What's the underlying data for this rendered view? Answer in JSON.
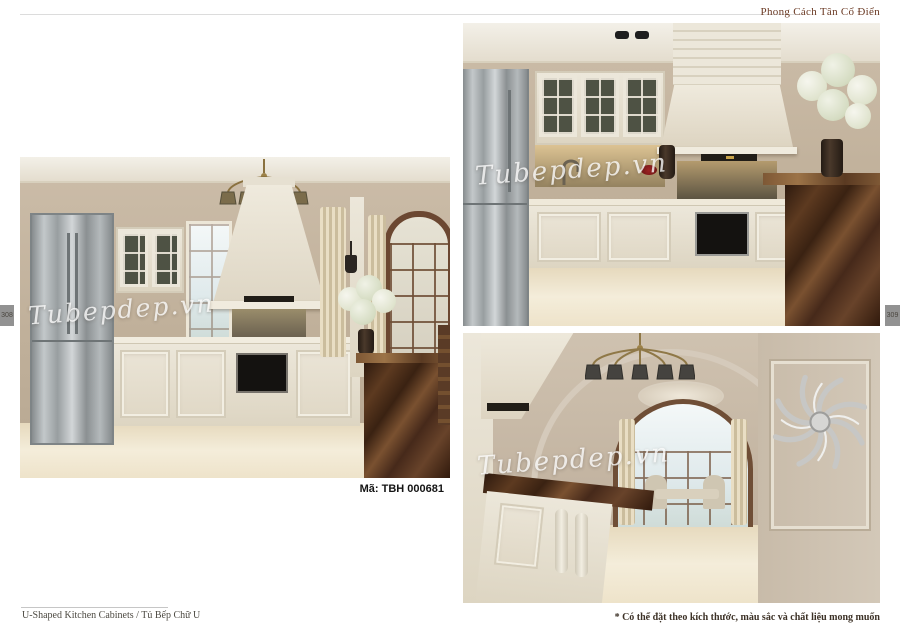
{
  "header": {
    "title": "Phong Cách Tân Cổ Điển"
  },
  "tabs": {
    "left": "308",
    "right": "309"
  },
  "watermark": "Tubepdep.vn",
  "main_image": {
    "caption": "Mã: TBH 000681"
  },
  "footer": {
    "left": "U-Shaped Kitchen Cabinets /  Tủ Bếp Chữ U",
    "right": "* Có thể đặt theo kích thước, màu sắc và chất liệu mong muốn"
  },
  "colors": {
    "header_text": "#6b3a24",
    "caption_text": "#141414",
    "footer_left_text": "#4d4a42",
    "footer_right_text": "#3c3126",
    "tab_background": "#929292",
    "tab_text": "#4a463f",
    "watermark_text": "#ffffff",
    "page_background": "#ffffff"
  }
}
